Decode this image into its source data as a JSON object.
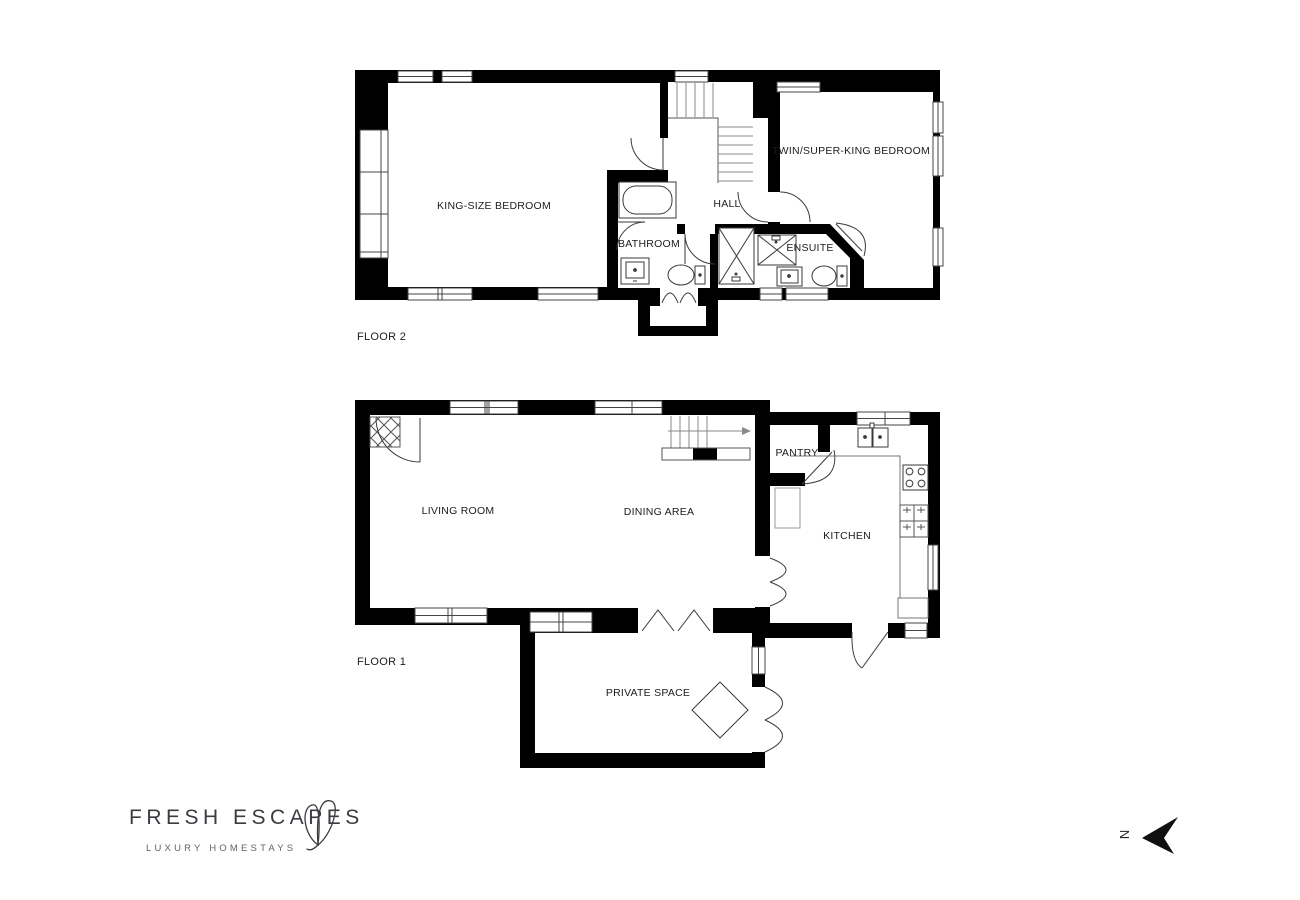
{
  "floor2": {
    "label": "FLOOR 2",
    "rooms": {
      "king": "KING-SIZE BEDROOM",
      "hall": "HALL",
      "bathroom": "BATHROOM",
      "ensuite": "ENSUITE",
      "twin": "TWIN/SUPER-KING BEDROOM"
    }
  },
  "floor1": {
    "label": "FLOOR 1",
    "rooms": {
      "living": "LIVING ROOM",
      "dining": "DINING AREA",
      "pantry": "PANTRY",
      "kitchen": "KITCHEN",
      "private": "PRIVATE SPACE"
    }
  },
  "logo": {
    "title": "FRESH ESCAPES",
    "subtitle": "LUXURY HOMESTAYS"
  },
  "compass": {
    "north_label": "N"
  },
  "colors": {
    "wall": "#000000",
    "fixture_line": "#3a3a3a",
    "text": "#1c1c1c",
    "logo_text": "#3b3b41"
  }
}
